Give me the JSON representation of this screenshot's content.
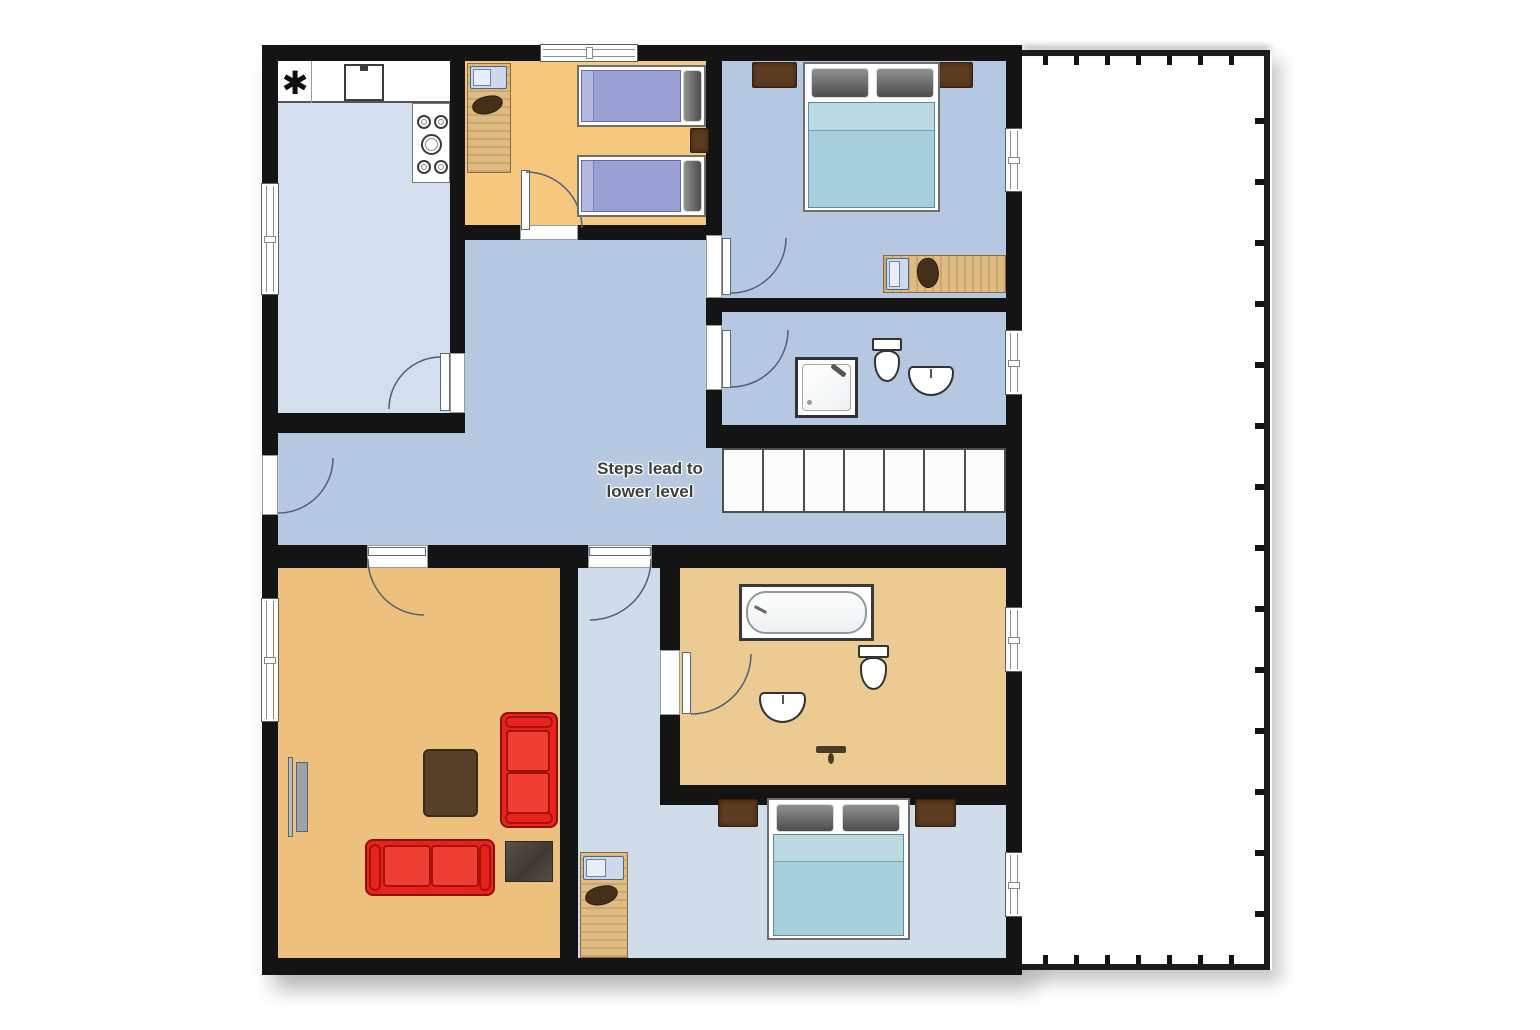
{
  "plan": {
    "note": {
      "line1": "Steps lead to",
      "line2": "lower level"
    },
    "kitchen_symbol": "✱",
    "stairs": {
      "step_count": 7
    },
    "colors": {
      "wall": "#141414",
      "kitchen_floor": "#d3dfec",
      "hall_floor": "#b7c8e1",
      "bedroom_blue_floor": "#b6c8e1",
      "lower_hall_floor": "#cfdcea",
      "twin_bedroom_floor": "#f6c87e",
      "living_room_floor": "#edc07d",
      "bathroom_tan_floor": "#eccb92",
      "sofa_red": "#e6231d",
      "bed_blanket_teal": "#a6cedb",
      "bed_blanket_purple": "#9aa0d3",
      "wood_desk": "#debb80",
      "nightstand_brown": "#5d3c1f",
      "coffee_table_brown": "#564028",
      "pillow_gray": "#6e6e6e",
      "stair_step": "#fcfcfc",
      "balcony_floor": "#ffffff"
    },
    "rooms": [
      {
        "name": "kitchen",
        "features": [
          "counter",
          "kitchen-sink",
          "stove",
          "appliance-symbol"
        ]
      },
      {
        "name": "twin-bedroom",
        "furniture": [
          "desk with laptop",
          "chair",
          "twin bed",
          "twin bed",
          "nightstand"
        ]
      },
      {
        "name": "master-bedroom",
        "furniture": [
          "nightstand",
          "double bed",
          "nightstand",
          "desk with laptop",
          "chair"
        ]
      },
      {
        "name": "upper-bathroom",
        "fixtures": [
          "shower",
          "toilet",
          "sink"
        ]
      },
      {
        "name": "landing-hallway",
        "features": [
          "staircase",
          "entrance door"
        ]
      },
      {
        "name": "living-room",
        "furniture": [
          "tv",
          "coffee table",
          "sofa",
          "sofa",
          "rug"
        ]
      },
      {
        "name": "lower-hallway",
        "furniture": [
          "desk with laptop",
          "chair"
        ]
      },
      {
        "name": "lower-bathroom",
        "fixtures": [
          "bathtub",
          "toilet",
          "sink",
          "towel rail"
        ]
      },
      {
        "name": "lower-bedroom",
        "furniture": [
          "nightstand",
          "double bed",
          "nightstand"
        ]
      },
      {
        "name": "balcony",
        "features": [
          "railing"
        ]
      }
    ]
  }
}
